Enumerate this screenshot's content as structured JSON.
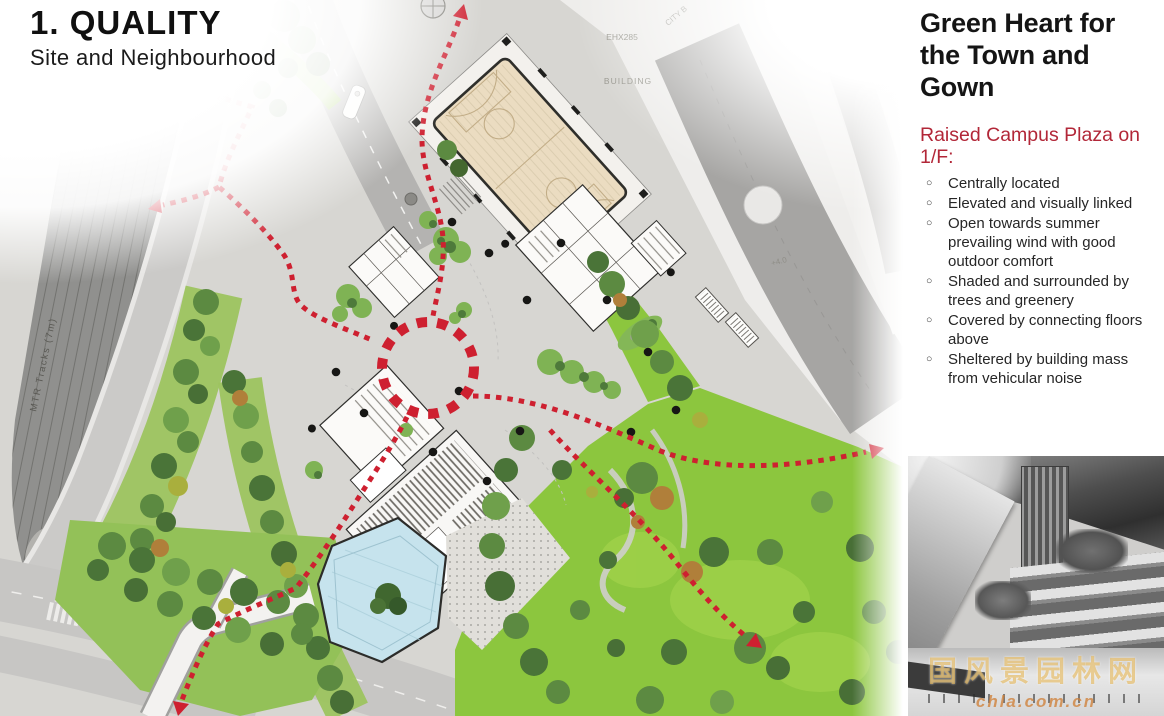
{
  "slide": {
    "title": "1.  QUALITY",
    "subtitle": "Site and Neighbourhood"
  },
  "sidebar": {
    "heading": "Green Heart for the Town and Gown",
    "subheading": "Raised Campus Plaza on 1/F:",
    "bullets": [
      "Centrally located",
      "Elevated and visually linked",
      "Open towards summer prevailing wind with good outdoor comfort",
      "Shaded and surrounded by trees and greenery",
      "Covered by connecting floors above",
      "Sheltered by building mass from vehicular noise"
    ],
    "bullet_glyph": "○"
  },
  "map": {
    "labels": {
      "mtr": "MTR Tracks (7m)",
      "lot": "EHX285",
      "building": "BUILDING",
      "city": "CITY B",
      "level": "+4.0"
    }
  },
  "photo": {
    "watermark_cn": "国风景园林网",
    "watermark_url": "chla.com.cn"
  },
  "colors": {
    "accent_red": "#ce2030",
    "heading_red": "#b22738",
    "lawn_green": "#8cc63e",
    "court_tan": "#ebdcc1",
    "pond_blue": "#c6e3ed"
  }
}
